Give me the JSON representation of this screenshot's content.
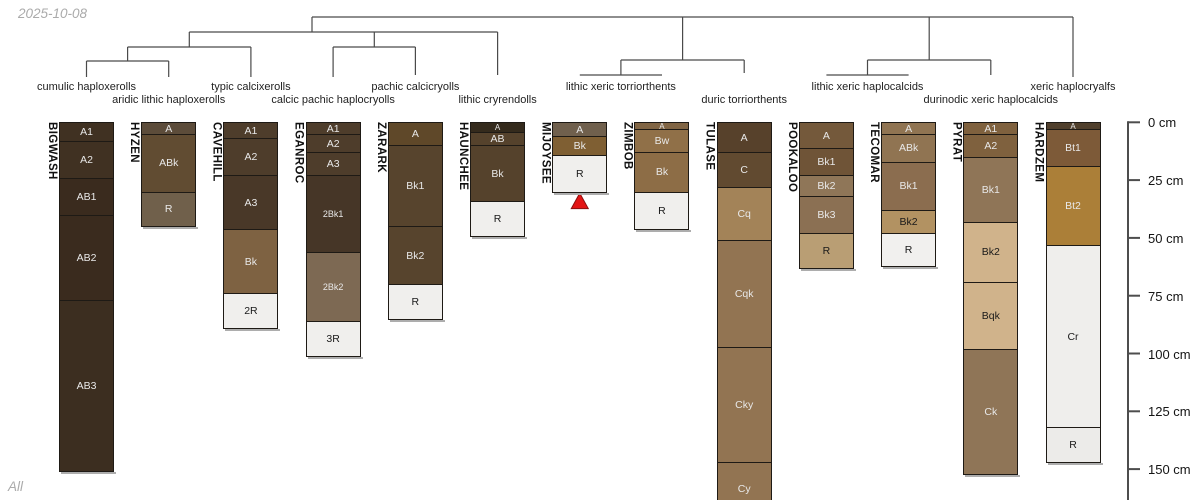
{
  "page": {
    "date_label": "2025-10-08",
    "footer_label": "All"
  },
  "chart_data": {
    "type": "soil-profile-dendrogram",
    "title": "",
    "depth_axis": {
      "unit": "cm",
      "ticks": [
        0,
        25,
        50,
        75,
        100,
        125,
        150
      ],
      "tick_labels": [
        "0 cm",
        "25 cm",
        "50 cm",
        "75 cm",
        "100 cm",
        "125 cm",
        "150 cm"
      ]
    },
    "line_color": "#4a4a4a",
    "taxa_labels": [
      {
        "label": "cumulic haploxerolls",
        "row": 1,
        "x": 86.5
      },
      {
        "label": "aridic lithic haploxerolls",
        "row": 2,
        "x": 168.7
      },
      {
        "label": "typic calcixerolls",
        "row": 1,
        "x": 250.9
      },
      {
        "label": "calcic pachic haplocryolls",
        "row": 2,
        "x": 333.1
      },
      {
        "label": "pachic calcicryolls",
        "row": 1,
        "x": 415.4
      },
      {
        "label": "lithic cryrendolls",
        "row": 2,
        "x": 497.6
      },
      {
        "label": "lithic xeric torriorthents",
        "row": 1,
        "x": 620.9
      },
      {
        "label": "duric torriorthents",
        "row": 2,
        "x": 744.2
      },
      {
        "label": "lithic xeric haplocalcids",
        "row": 1,
        "x": 867.5
      },
      {
        "label": "durinodic xeric haplocalcids",
        "row": 2,
        "x": 990.8
      },
      {
        "label": "xeric haplocryalfs",
        "row": 1,
        "x": 1073
      }
    ],
    "dendrogram_segments": [
      [
        312,
        17,
        1073,
        17
      ],
      [
        312,
        17,
        312,
        32
      ],
      [
        682.6,
        17,
        682.6,
        60
      ],
      [
        929.2,
        17,
        929.2,
        60
      ],
      [
        1073,
        17,
        1073,
        77
      ],
      [
        189.3,
        32,
        497.6,
        32
      ],
      [
        189.3,
        32,
        189.3,
        47
      ],
      [
        374.3,
        32,
        374.3,
        47
      ],
      [
        497.6,
        32,
        497.6,
        75
      ],
      [
        127.6,
        47,
        250.9,
        47
      ],
      [
        127.6,
        47,
        127.6,
        61
      ],
      [
        250.9,
        47,
        250.9,
        77
      ],
      [
        86.5,
        61,
        168.7,
        61
      ],
      [
        86.5,
        61,
        86.5,
        77
      ],
      [
        168.7,
        61,
        168.7,
        77
      ],
      [
        333.1,
        47,
        415.4,
        47
      ],
      [
        333.1,
        47,
        333.1,
        77
      ],
      [
        415.4,
        47,
        415.4,
        75
      ],
      [
        620.9,
        60,
        744.2,
        60
      ],
      [
        620.9,
        60,
        620.9,
        75
      ],
      [
        744.2,
        60,
        744.2,
        73
      ],
      [
        579.8,
        75,
        662,
        75
      ],
      [
        867.5,
        60,
        990.8,
        60
      ],
      [
        867.5,
        60,
        867.5,
        75
      ],
      [
        990.8,
        60,
        990.8,
        75
      ],
      [
        826.4,
        75,
        908.6,
        75
      ]
    ],
    "marker": {
      "profile": "MIJOYSEE",
      "symbol": "filled-triangle-up",
      "fill": "#e31414",
      "stroke": "#8a1010"
    },
    "profiles": [
      {
        "id": "BIGWASH",
        "taxon": "cumulic haploxerolls",
        "horizons": [
          {
            "name": "A1",
            "top": 0,
            "bottom": 8,
            "color": "#403122"
          },
          {
            "name": "A2",
            "top": 8,
            "bottom": 24,
            "color": "#403122"
          },
          {
            "name": "AB1",
            "top": 24,
            "bottom": 40,
            "color": "#3a2b1e"
          },
          {
            "name": "AB2",
            "top": 40,
            "bottom": 77,
            "color": "#3a2b1e"
          },
          {
            "name": "AB3",
            "top": 77,
            "bottom": 151,
            "color": "#3c2e20"
          }
        ]
      },
      {
        "id": "HYZEN",
        "taxon": "aridic lithic haploxerolls",
        "horizons": [
          {
            "name": "A",
            "top": 0,
            "bottom": 5,
            "color": "#5c4c3a"
          },
          {
            "name": "ABk",
            "top": 5,
            "bottom": 30,
            "color": "#614c32"
          },
          {
            "name": "R",
            "top": 30,
            "bottom": 45,
            "color": "#70604b"
          }
        ]
      },
      {
        "id": "CAVEHILL",
        "taxon": "typic calcixerolls",
        "horizons": [
          {
            "name": "A1",
            "top": 0,
            "bottom": 7,
            "color": "#4e3d2b"
          },
          {
            "name": "A2",
            "top": 7,
            "bottom": 23,
            "color": "#4e3d2b"
          },
          {
            "name": "A3",
            "top": 23,
            "bottom": 46,
            "color": "#493828"
          },
          {
            "name": "Bk",
            "top": 46,
            "bottom": 74,
            "color": "#7e6242"
          },
          {
            "name": "2R",
            "top": 74,
            "bottom": 89,
            "color": "#f0efed"
          }
        ]
      },
      {
        "id": "EGANROC",
        "taxon": "calcic pachic haplocryolls",
        "horizons": [
          {
            "name": "A1",
            "top": 0,
            "bottom": 5,
            "color": "#4e3d2b"
          },
          {
            "name": "A2",
            "top": 5,
            "bottom": 13,
            "color": "#4e3d2b"
          },
          {
            "name": "A3",
            "top": 13,
            "bottom": 23,
            "color": "#4e3d2b"
          },
          {
            "name": "2Bk1",
            "top": 23,
            "bottom": 56,
            "color": "#463627"
          },
          {
            "name": "2Bk2",
            "top": 56,
            "bottom": 86,
            "color": "#7d6953"
          },
          {
            "name": "3R",
            "top": 86,
            "bottom": 101,
            "color": "#f0efed"
          }
        ]
      },
      {
        "id": "ZARARK",
        "taxon": "pachic calcicryolls",
        "horizons": [
          {
            "name": "A",
            "top": 0,
            "bottom": 10,
            "color": "#5f4829"
          },
          {
            "name": "Bk1",
            "top": 10,
            "bottom": 45,
            "color": "#57442d"
          },
          {
            "name": "Bk2",
            "top": 45,
            "bottom": 70,
            "color": "#57442d"
          },
          {
            "name": "R",
            "top": 70,
            "bottom": 85,
            "color": "#f0efed"
          }
        ]
      },
      {
        "id": "HAUNCHEE",
        "taxon": "lithic cryrendolls",
        "horizons": [
          {
            "name": "A",
            "top": 0,
            "bottom": 4,
            "color": "#342a1c"
          },
          {
            "name": "AB",
            "top": 4,
            "bottom": 10,
            "color": "#55422c"
          },
          {
            "name": "Bk",
            "top": 10,
            "bottom": 34,
            "color": "#55422c"
          },
          {
            "name": "R",
            "top": 34,
            "bottom": 49,
            "color": "#f0efed"
          }
        ]
      },
      {
        "id": "MIJOYSEE",
        "taxon": "lithic xeric torriorthents",
        "marker": true,
        "horizons": [
          {
            "name": "A",
            "top": 0,
            "bottom": 6,
            "color": "#70604d"
          },
          {
            "name": "Bk",
            "top": 6,
            "bottom": 14,
            "color": "#7f5f33"
          },
          {
            "name": "R",
            "top": 14,
            "bottom": 30,
            "color": "#f0efed"
          }
        ]
      },
      {
        "id": "ZIMBOB",
        "taxon": "lithic xeric torriorthents",
        "horizons": [
          {
            "name": "A",
            "top": 0,
            "bottom": 3,
            "color": "#816544"
          },
          {
            "name": "Bw",
            "top": 3,
            "bottom": 13,
            "color": "#907048"
          },
          {
            "name": "Bk",
            "top": 13,
            "bottom": 30,
            "color": "#8d6d46"
          },
          {
            "name": "R",
            "top": 30,
            "bottom": 46,
            "color": "#f0efed"
          }
        ]
      },
      {
        "id": "TULASE",
        "taxon": "duric torriorthents",
        "clipped": true,
        "horizons": [
          {
            "name": "A",
            "top": 0,
            "bottom": 13,
            "color": "#57412b"
          },
          {
            "name": "C",
            "top": 13,
            "bottom": 28,
            "color": "#614a30"
          },
          {
            "name": "Cq",
            "top": 28,
            "bottom": 51,
            "color": "#a38358"
          },
          {
            "name": "Cqk",
            "top": 51,
            "bottom": 97,
            "color": "#927452"
          },
          {
            "name": "Cky",
            "top": 97,
            "bottom": 147,
            "color": "#927452"
          },
          {
            "name": "Cy",
            "top": 147,
            "bottom": 170,
            "color": "#927452"
          }
        ]
      },
      {
        "id": "POOKALOO",
        "taxon": "lithic xeric haplocalcids",
        "horizons": [
          {
            "name": "A",
            "top": 0,
            "bottom": 11,
            "color": "#74593b"
          },
          {
            "name": "Bk1",
            "top": 11,
            "bottom": 23,
            "color": "#6f5437"
          },
          {
            "name": "Bk2",
            "top": 23,
            "bottom": 32,
            "color": "#8f7658"
          },
          {
            "name": "Bk3",
            "top": 32,
            "bottom": 48,
            "color": "#8b7053"
          },
          {
            "name": "R",
            "top": 48,
            "bottom": 63,
            "color": "#b99e74"
          }
        ]
      },
      {
        "id": "TECOMAR",
        "taxon": "lithic xeric haplocalcids",
        "horizons": [
          {
            "name": "A",
            "top": 0,
            "bottom": 5,
            "color": "#907452"
          },
          {
            "name": "ABk",
            "top": 5,
            "bottom": 17,
            "color": "#907452"
          },
          {
            "name": "Bk1",
            "top": 17,
            "bottom": 38,
            "color": "#8b6d4f"
          },
          {
            "name": "Bk2",
            "top": 38,
            "bottom": 48,
            "color": "#b29262"
          },
          {
            "name": "R",
            "top": 48,
            "bottom": 62,
            "color": "#f1f0ee"
          }
        ]
      },
      {
        "id": "PYRAT",
        "taxon": "durinodic xeric haplocalcids",
        "horizons": [
          {
            "name": "A1",
            "top": 0,
            "bottom": 5,
            "color": "#7f613e"
          },
          {
            "name": "A2",
            "top": 5,
            "bottom": 15,
            "color": "#7f613e"
          },
          {
            "name": "Bk1",
            "top": 15,
            "bottom": 43,
            "color": "#8f7557"
          },
          {
            "name": "Bk2",
            "top": 43,
            "bottom": 69,
            "color": "#d0b38b"
          },
          {
            "name": "Bqk",
            "top": 69,
            "bottom": 98,
            "color": "#d0b38b"
          },
          {
            "name": "Ck",
            "top": 98,
            "bottom": 152,
            "color": "#8f7557"
          }
        ]
      },
      {
        "id": "HARDZEM",
        "taxon": "xeric haplocryalfs",
        "horizons": [
          {
            "name": "A",
            "top": 0,
            "bottom": 3,
            "color": "#503f2c"
          },
          {
            "name": "Bt1",
            "top": 3,
            "bottom": 19,
            "color": "#7d5a38"
          },
          {
            "name": "Bt2",
            "top": 19,
            "bottom": 53,
            "color": "#ab7f38"
          },
          {
            "name": "Cr",
            "top": 53,
            "bottom": 132,
            "color": "#efeeec"
          },
          {
            "name": "R",
            "top": 132,
            "bottom": 147,
            "color": "#ecebe9"
          }
        ]
      }
    ]
  }
}
